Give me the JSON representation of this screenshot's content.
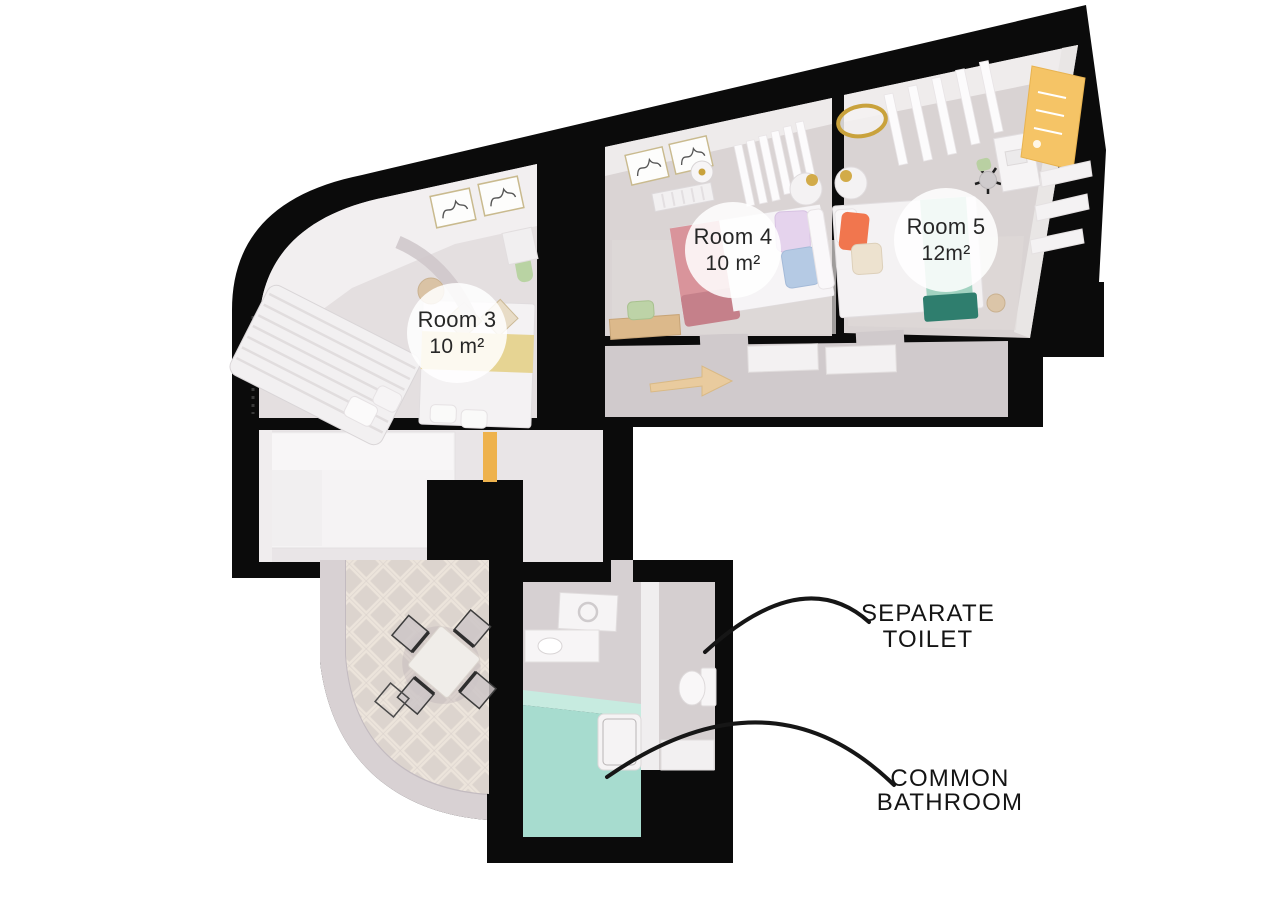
{
  "plan": {
    "type": "3D apartment floor plan",
    "rooms": [
      {
        "key": "room-3",
        "label": "Room 3",
        "area": "10 m²"
      },
      {
        "key": "room-4",
        "label": "Room 4",
        "area": "10 m²"
      },
      {
        "key": "room-5",
        "label": "Room 5",
        "area": "12m²"
      }
    ],
    "zones": [
      {
        "key": "separate-toilet",
        "line1": "SEPARATE",
        "line2": "TOILET"
      },
      {
        "key": "common-bathroom",
        "line1": "COMMON",
        "line2": "BATHROOM"
      }
    ],
    "colors": {
      "walls": "#0b0b0b",
      "room_floor": "#d9d3d3",
      "corridor_floor": "#d0cacc",
      "living_floor": "#e9e5e7",
      "mosaic_floor": "#d7cec9",
      "bathroom_floor_teal": "#a7dccf",
      "bathroom_floor_gray": "#d6d0d2",
      "bed_pink": "#d9949b",
      "bed_teal_runner": "#a2d3c1",
      "bed_teal_dark": "#2f7e6e",
      "pillow_orange": "#f1764e",
      "wardrobe_yellow": "#f5c466",
      "door_yellow": "#eeb24d",
      "bedspread_yellow": "#e6d493",
      "gold_accent": "#c9a23c",
      "label_circle": "#ffffff",
      "text": "#272727",
      "leader_line": "#161616"
    }
  }
}
